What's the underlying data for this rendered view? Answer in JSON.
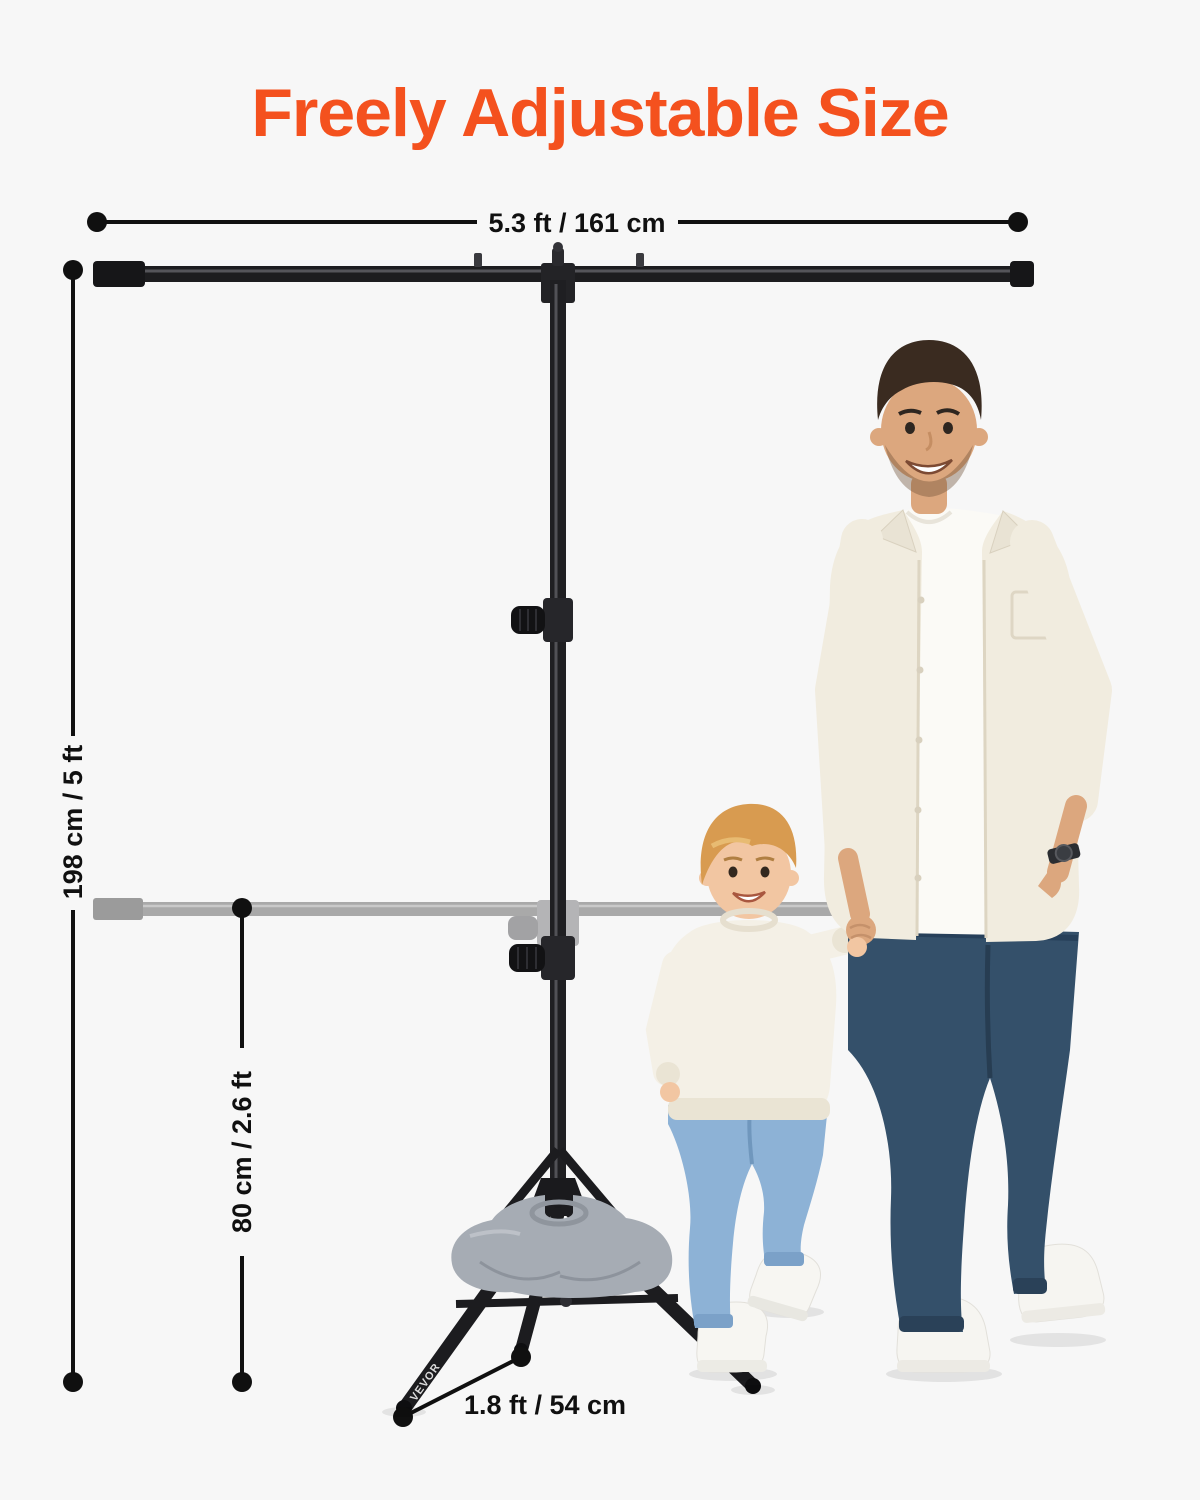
{
  "page": {
    "background_color": "#F7F7F7"
  },
  "title": {
    "text": "Freely Adjustable Size",
    "color": "#F4511E"
  },
  "dimensions": {
    "crossbar_width": {
      "label": "5.3 ft / 161 cm"
    },
    "stand_height": {
      "label": "198 cm / 5 ft"
    },
    "lowered_crossbar_height": {
      "label": "80 cm / 2.6 ft"
    },
    "tripod_leg": {
      "label": "1.8 ft / 54 cm"
    }
  },
  "stand": {
    "brand_label": "VEVOR"
  },
  "colors": {
    "accent_orange": "#F4511E",
    "dimension_line": "#101010",
    "stand_black": "#1F1F21",
    "ghost_bar_gray": "#A9A9A9",
    "sandbag_gray": "#A6ACB4"
  }
}
